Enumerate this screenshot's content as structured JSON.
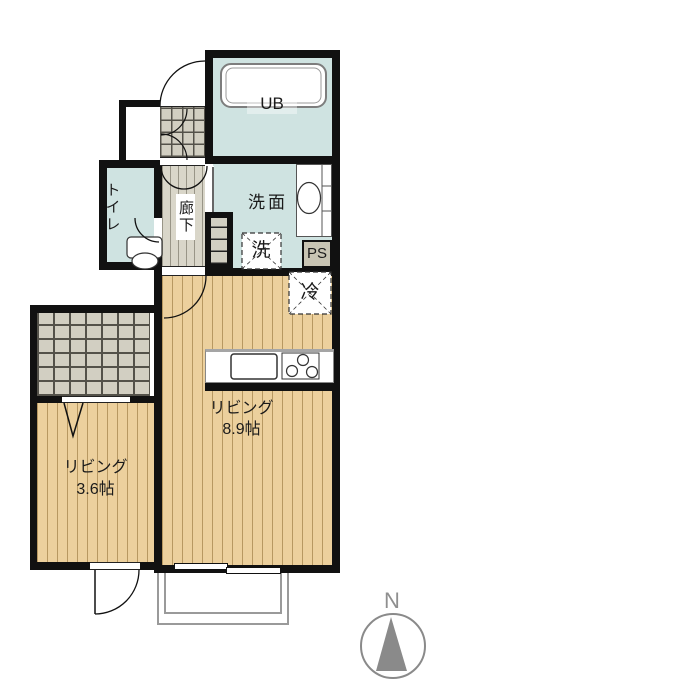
{
  "title": "apartment-floor-plan",
  "rooms": {
    "ub": {
      "label": "UB"
    },
    "toilet": {
      "label": "トイレ"
    },
    "hallway": {
      "label": "廊下"
    },
    "washroom": {
      "label": "洗面"
    },
    "washer": {
      "label": "洗"
    },
    "pipe_space": {
      "label": "PS"
    },
    "refrigerator": {
      "label": "冷"
    },
    "living_main": {
      "label": "リビング",
      "size": "8.9帖"
    },
    "living_sub": {
      "label": "リビング",
      "size": "3.6帖"
    }
  },
  "compass": {
    "label": "N"
  },
  "colors": {
    "wall": "#111111",
    "wet_room_floor": "#cfe3e1",
    "wood_floor": "#ecd09d",
    "tile_floor": "#d2cfc2",
    "hall_floor": "#d9d6c9",
    "balcony_line": "#9a9a9a",
    "compass_gray": "#8a8a8a",
    "ps_fill": "#c8c4b3"
  }
}
